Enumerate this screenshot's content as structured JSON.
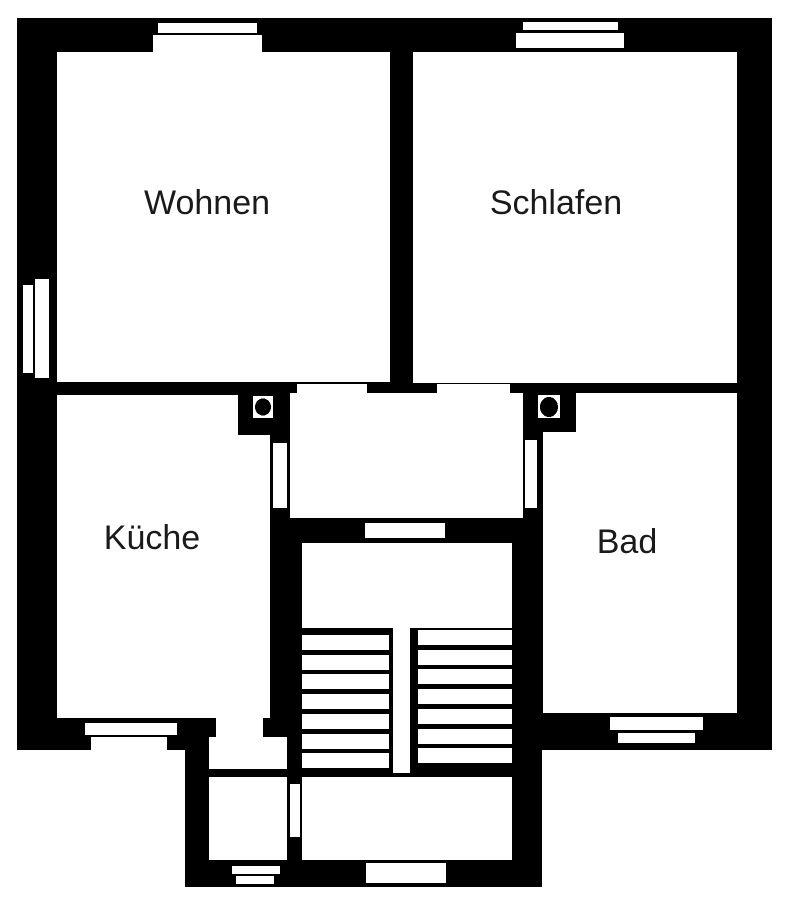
{
  "plan": {
    "canvas": {
      "width": 785,
      "height": 900,
      "background": "#ffffff",
      "wall_color": "#000000",
      "floor_color": "#ffffff"
    },
    "label_font_size": 34,
    "rooms": [
      {
        "name": "room-label-wohnen",
        "label": "Wohnen",
        "x": 207,
        "y": 203
      },
      {
        "name": "room-label-schlafen",
        "label": "Schlafen",
        "x": 556,
        "y": 203
      },
      {
        "name": "room-label-kueche",
        "label": "Küche",
        "x": 152,
        "y": 538
      },
      {
        "name": "room-label-bad",
        "label": "Bad",
        "x": 627,
        "y": 542
      }
    ],
    "black_base": [
      {
        "name": "outer-wall-main-block",
        "x": 17,
        "y": 18,
        "w": 755,
        "h": 732
      },
      {
        "name": "outer-wall-entry-annex",
        "x": 185,
        "y": 745,
        "w": 357,
        "h": 142
      }
    ],
    "white_areas": [
      {
        "name": "room-wohnen",
        "x": 57,
        "y": 52,
        "w": 333,
        "h": 330
      },
      {
        "name": "room-schlafen",
        "x": 413,
        "y": 52,
        "w": 324,
        "h": 331
      },
      {
        "name": "room-kueche",
        "x": 57,
        "y": 395,
        "w": 213,
        "h": 323
      },
      {
        "name": "room-bad",
        "x": 543,
        "y": 393,
        "w": 194,
        "h": 320
      },
      {
        "name": "hallway",
        "x": 290,
        "y": 393,
        "w": 233,
        "h": 125
      },
      {
        "name": "stair-upper-landing",
        "x": 302,
        "y": 543,
        "w": 210,
        "h": 85
      },
      {
        "name": "stair-lower-landing",
        "x": 302,
        "y": 777,
        "w": 210,
        "h": 83
      },
      {
        "name": "stair-eye-strip",
        "x": 393,
        "y": 628,
        "w": 17,
        "h": 145
      },
      {
        "name": "vestibule-upper",
        "x": 209,
        "y": 737,
        "w": 78,
        "h": 32
      },
      {
        "name": "vestibule-lower",
        "x": 209,
        "y": 777,
        "w": 78,
        "h": 83
      }
    ],
    "windows": [
      {
        "name": "window-wohnen-top-outer",
        "x": 158,
        "y": 23,
        "w": 99,
        "h": 10
      },
      {
        "name": "window-wohnen-top-inner",
        "x": 153,
        "y": 35,
        "w": 109,
        "h": 17
      },
      {
        "name": "window-schlafen-top-outer",
        "x": 523,
        "y": 22,
        "w": 95,
        "h": 8
      },
      {
        "name": "window-schlafen-top-inner",
        "x": 516,
        "y": 33,
        "w": 108,
        "h": 15
      },
      {
        "name": "window-wohnen-left-outer",
        "x": 23,
        "y": 285,
        "w": 10,
        "h": 88
      },
      {
        "name": "window-wohnen-left-inner",
        "x": 35,
        "y": 279,
        "w": 14,
        "h": 99
      },
      {
        "name": "window-kueche-bottom-inner",
        "x": 85,
        "y": 723,
        "w": 92,
        "h": 12
      },
      {
        "name": "window-kueche-bottom-outer",
        "x": 91,
        "y": 737,
        "w": 76,
        "h": 14
      },
      {
        "name": "window-bad-bottom-inner",
        "x": 610,
        "y": 717,
        "w": 93,
        "h": 13
      },
      {
        "name": "window-bad-bottom-outer",
        "x": 618,
        "y": 733,
        "w": 77,
        "h": 10
      },
      {
        "name": "window-vestibule-bottom-inner",
        "x": 232,
        "y": 866,
        "w": 48,
        "h": 8
      },
      {
        "name": "window-vestibule-bottom-outer",
        "x": 236,
        "y": 876,
        "w": 38,
        "h": 8
      }
    ],
    "doors": [
      {
        "name": "door-wohnen-hallway",
        "x": 297,
        "y": 384,
        "w": 70,
        "h": 10
      },
      {
        "name": "door-schlafen-hallway",
        "x": 437,
        "y": 384,
        "w": 73,
        "h": 9
      },
      {
        "name": "door-kueche-hallway",
        "x": 273,
        "y": 443,
        "w": 14,
        "h": 65
      },
      {
        "name": "door-bad-hallway",
        "x": 525,
        "y": 440,
        "w": 12,
        "h": 68
      },
      {
        "name": "door-hallway-stairs",
        "x": 365,
        "y": 523,
        "w": 80,
        "h": 15
      },
      {
        "name": "door-kueche-vestibule",
        "x": 216,
        "y": 718,
        "w": 47,
        "h": 19
      },
      {
        "name": "door-vestibule-stairs",
        "x": 290,
        "y": 784,
        "w": 10,
        "h": 53
      },
      {
        "name": "entrance-opening",
        "x": 366,
        "y": 863,
        "w": 80,
        "h": 20
      }
    ],
    "black_overlays": [
      {
        "name": "chimney-nook-left",
        "x": 238,
        "y": 385,
        "w": 52,
        "h": 50
      },
      {
        "name": "chimney-nook-right",
        "x": 523,
        "y": 385,
        "w": 53,
        "h": 47
      }
    ],
    "chimneys": [
      {
        "name": "chimney-left",
        "box": {
          "x": 253,
          "y": 396,
          "w": 20,
          "h": 22
        },
        "dot": {
          "cx": 263,
          "cy": 407,
          "rx": 8,
          "ry": 8.5
        }
      },
      {
        "name": "chimney-right",
        "box": {
          "x": 538,
          "y": 395,
          "w": 22,
          "h": 23
        },
        "dot": {
          "cx": 549,
          "cy": 407,
          "rx": 9,
          "ry": 10
        }
      }
    ],
    "stairs": {
      "left_flight": {
        "name": "stair-flight-left",
        "x": 302,
        "w": 87,
        "y_start": 635,
        "tread_h": 15,
        "pitch": 19.7,
        "count": 7
      },
      "right_flight": {
        "name": "stair-flight-right",
        "x": 418,
        "w": 94,
        "y_start": 630,
        "tread_h": 15,
        "pitch": 19.7,
        "count": 7
      }
    }
  }
}
